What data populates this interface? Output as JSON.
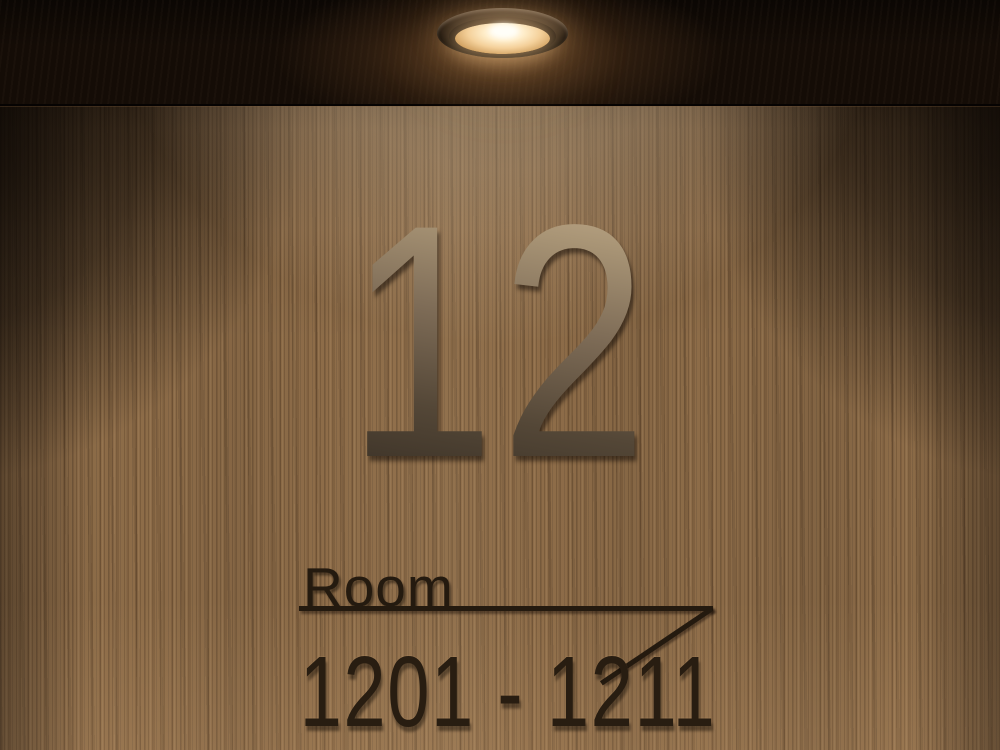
{
  "scene": {
    "description": "Hotel floor sign mounted on a wood veneer wall, lit by a recessed ceiling downlight"
  },
  "sign": {
    "floor_number": "12",
    "room_label": "Room",
    "room_range": "1201 - 1211",
    "arrow_direction": "right"
  },
  "lamp": {
    "type": "recessed-round-downlight",
    "glow_color": "#ffeecb",
    "core_color": "#fffdf4"
  },
  "colors": {
    "wood_base": "#8d6c48",
    "wood_lit": "#b99a76",
    "shadow_dark": "#0d0703",
    "ceiling": "#140c06",
    "numeral_gradient_top": "#cab393",
    "numeral_gradient_bottom": "#372e24",
    "sign_text": "#241a0f"
  }
}
